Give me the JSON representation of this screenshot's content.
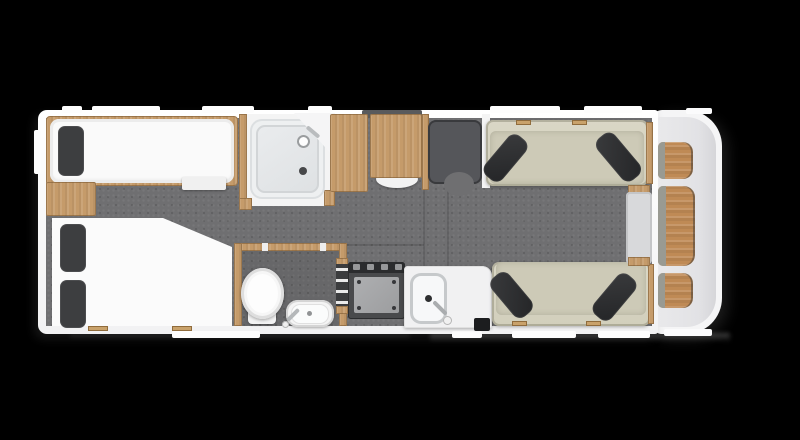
{
  "meta": {
    "type": "caravan-floor-plan",
    "orientation": "top-down"
  },
  "canvas": {
    "w": 800,
    "h": 440,
    "background": "#000000"
  },
  "palette": {
    "wall": "#f5f5f6",
    "floor": "#6f6f71",
    "wood": "#c59b6a",
    "front_wood": "#bf8a55",
    "mattress": "#fafafa",
    "pillow": "#3d3e40",
    "sofa": "#d6d3c1",
    "cushion": "#2e2f31",
    "fixture_white": "#f4f4f4",
    "hob_dark": "#494a4c",
    "vent": "#595a5c"
  },
  "items": [
    {
      "n": "ground-shadow-right",
      "x": 430,
      "y": 333,
      "w": 300,
      "h": 9,
      "f": "linear-gradient(180deg, rgba(150,150,150,0.45), rgba(0,0,0,0))",
      "flt": "blur(2px)"
    },
    {
      "n": "ground-shadow-left",
      "x": 70,
      "y": 333,
      "w": 340,
      "h": 7,
      "f": "linear-gradient(180deg, rgba(110,110,110,0.30), rgba(0,0,0,0))",
      "flt": "blur(2px)"
    },
    {
      "n": "front-body-outer",
      "x": 652,
      "y": 110,
      "w": 70,
      "h": 224,
      "f": "#f5f5f6",
      "r": "10px 36px 36px 10px",
      "s": "6px 5px 14px rgba(80,80,80,0.35)"
    },
    {
      "n": "main-body-wall",
      "x": 38,
      "y": 110,
      "w": 620,
      "h": 224,
      "f": "linear-gradient(180deg,#ffffff,#f2f2f3)",
      "r": "9px 3px 3px 9px",
      "s": "-4px 5px 10px rgba(70,70,70,0.30)"
    },
    {
      "n": "front-body-inner",
      "x": 658,
      "y": 117,
      "w": 58,
      "h": 210,
      "f": "linear-gradient(90deg,#e9e9eb,#e2e2e5 70%,#d6d6d9)",
      "r": "2px 30px 30px 2px"
    },
    {
      "n": "window-left-wall",
      "x": 34,
      "y": 130,
      "w": 7,
      "h": 44,
      "f": "#fdfdfd",
      "r": "2px"
    },
    {
      "n": "window-top-1",
      "x": 62,
      "y": 106,
      "w": 20,
      "h": 7,
      "f": "#fdfdfd",
      "r": "2px"
    },
    {
      "n": "window-top-2",
      "x": 92,
      "y": 106,
      "w": 68,
      "h": 7,
      "f": "#fdfdfd",
      "r": "2px"
    },
    {
      "n": "window-top-3",
      "x": 202,
      "y": 106,
      "w": 52,
      "h": 7,
      "f": "#fdfdfd",
      "r": "2px"
    },
    {
      "n": "window-top-4",
      "x": 308,
      "y": 106,
      "w": 24,
      "h": 7,
      "f": "#fdfdfd",
      "r": "2px"
    },
    {
      "n": "window-top-5",
      "x": 490,
      "y": 106,
      "w": 70,
      "h": 7,
      "f": "#fdfdfd",
      "r": "2px"
    },
    {
      "n": "window-top-6",
      "x": 584,
      "y": 106,
      "w": 58,
      "h": 7,
      "f": "#fdfdfd",
      "r": "2px"
    },
    {
      "n": "window-top-front",
      "x": 686,
      "y": 108,
      "w": 26,
      "h": 6,
      "f": "#fbfbfc",
      "r": "2px"
    },
    {
      "n": "window-bottom-1",
      "x": 172,
      "y": 331,
      "w": 88,
      "h": 7,
      "f": "#fdfdfd",
      "r": "2px"
    },
    {
      "n": "window-bottom-2",
      "x": 452,
      "y": 331,
      "w": 30,
      "h": 7,
      "f": "#fdfdfd",
      "r": "2px"
    },
    {
      "n": "window-bottom-3",
      "x": 512,
      "y": 331,
      "w": 64,
      "h": 7,
      "f": "#fdfdfd",
      "r": "2px"
    },
    {
      "n": "window-bottom-4",
      "x": 598,
      "y": 331,
      "w": 52,
      "h": 7,
      "f": "#fdfdfd",
      "r": "2px"
    },
    {
      "n": "window-bottom-front",
      "x": 664,
      "y": 329,
      "w": 48,
      "h": 7,
      "f": "#fbfbfc",
      "r": "2px"
    },
    {
      "n": "roof-vent",
      "x": 362,
      "y": 110,
      "w": 60,
      "h": 9,
      "f": "#595a5c",
      "r": "2px"
    },
    {
      "n": "interior-floor",
      "c": "floor",
      "x": 46,
      "y": 118,
      "w": 606,
      "h": 208
    },
    {
      "n": "floor-seam-1",
      "x": 423,
      "y": 186,
      "w": 2,
      "h": 80,
      "f": "rgba(0,0,0,0.13)"
    },
    {
      "n": "floor-seam-2",
      "x": 447,
      "y": 188,
      "w": 2,
      "h": 78,
      "f": "rgba(0,0,0,0.13)"
    },
    {
      "n": "floor-seam-3",
      "x": 346,
      "y": 244,
      "w": 78,
      "h": 2,
      "f": "rgba(0,0,0,0.13)"
    },
    {
      "n": "single-bed-frame",
      "c": "wood",
      "x": 46,
      "y": 116,
      "w": 192,
      "h": 70,
      "r": "4px"
    },
    {
      "n": "single-bed-mattress",
      "x": 50,
      "y": 119,
      "w": 184,
      "h": 64,
      "f": "#fafafa",
      "r": "9px",
      "s": "inset 0 0 0 3px #ececec, inset 0 -2px 4px rgba(0,0,0,0.12)"
    },
    {
      "n": "single-bed-pillow",
      "x": 58,
      "y": 126,
      "w": 26,
      "h": 50,
      "f": "#3d3e40",
      "r": "7px",
      "s": "inset 0 0 0 1px rgba(255,255,255,0.08)"
    },
    {
      "n": "bed-step",
      "x": 182,
      "y": 177,
      "w": 44,
      "h": 13,
      "f": "#f0f0f0",
      "r": "2px",
      "s": "0 1px 2px rgba(0,0,0,0.35)"
    },
    {
      "n": "left-cabinet",
      "c": "wood",
      "x": 46,
      "y": 182,
      "w": 50,
      "h": 34,
      "r": "2px"
    },
    {
      "n": "corner-bed",
      "x": 52,
      "y": 218,
      "w": 180,
      "h": 108,
      "f": "#fbfbfb",
      "p": "polygon(0 0, 111px 0, 180px 29px, 180px 108px, 0 108px)",
      "flt": "drop-shadow(0 0 2px rgba(0,0,0,0.35))"
    },
    {
      "n": "corner-bed-pillow-1",
      "x": 60,
      "y": 224,
      "w": 26,
      "h": 48,
      "f": "#3d3e40",
      "r": "7px",
      "s": "inset 0 0 0 1px rgba(255,255,255,0.08)"
    },
    {
      "n": "corner-bed-pillow-2",
      "x": 60,
      "y": 280,
      "w": 26,
      "h": 48,
      "f": "#3d3e40",
      "r": "7px",
      "s": "inset 0 0 0 1px rgba(255,255,255,0.08)"
    },
    {
      "n": "bed-hinge-1",
      "x": 88,
      "y": 326,
      "w": 20,
      "h": 5,
      "f": "#c9a26b",
      "s": "inset 0 0 0 1px rgba(120,85,40,0.7)"
    },
    {
      "n": "bed-hinge-2",
      "x": 172,
      "y": 326,
      "w": 20,
      "h": 5,
      "f": "#c9a26b",
      "s": "inset 0 0 0 1px rgba(120,85,40,0.7)"
    },
    {
      "n": "shower-room",
      "x": 244,
      "y": 114,
      "w": 88,
      "h": 92,
      "f": "#f4f4f4"
    },
    {
      "n": "shower-wall-left",
      "c": "wood",
      "x": 239,
      "y": 114,
      "w": 8,
      "h": 96
    },
    {
      "n": "shower-post-bottom-left",
      "c": "wood",
      "x": 239,
      "y": 198,
      "w": 13,
      "h": 12
    },
    {
      "n": "shower-post-bottom-right",
      "c": "wood",
      "x": 324,
      "y": 190,
      "w": 11,
      "h": 16
    },
    {
      "n": "shower-tray",
      "x": 250,
      "y": 119,
      "w": 75,
      "h": 80,
      "f": "#eef0f1",
      "r": "12px",
      "s": "inset 0 0 0 2px #dcdfe1"
    },
    {
      "n": "shower-tray-inner",
      "x": 256,
      "y": 125,
      "w": 63,
      "h": 68,
      "f": "linear-gradient(145deg,#eaecee,#dee1e3)",
      "r": "9px",
      "s": "inset 0 0 0 2px #d2d5d7"
    },
    {
      "n": "shower-corner-wall",
      "x": 294,
      "y": 113,
      "w": 41,
      "h": 45,
      "f": "#f5f5f6",
      "p": "polygon(0 0, 41px 0, 41px 45px)"
    },
    {
      "n": "shower-drain",
      "x": 299,
      "y": 167,
      "w": 8,
      "h": 8,
      "f": "#47484a",
      "r": "50%"
    },
    {
      "n": "shower-hose",
      "x": 305,
      "y": 130,
      "w": 16,
      "h": 4,
      "f": "#b9bcbe",
      "r": "2px",
      "o": 40
    },
    {
      "n": "shower-head-icon",
      "x": 297,
      "y": 135,
      "w": 13,
      "h": 13,
      "f": "#fdfdfd",
      "r": "50%",
      "s": "inset 0 0 0 2px #9a9d9f"
    },
    {
      "n": "wardrobe-left",
      "c": "wood",
      "x": 330,
      "y": 114,
      "w": 38,
      "h": 78,
      "r": "2px"
    },
    {
      "n": "stored-table",
      "x": 376,
      "y": 170,
      "w": 42,
      "h": 18,
      "f": "#f2f2f2",
      "r": "50%",
      "s": "0 1px 2px rgba(0,0,0,0.3)"
    },
    {
      "n": "wardrobe-right",
      "c": "wood",
      "x": 370,
      "y": 114,
      "w": 52,
      "h": 64,
      "r": "2px"
    },
    {
      "n": "door-post",
      "c": "wood",
      "x": 422,
      "y": 114,
      "w": 7,
      "h": 76
    },
    {
      "n": "entry-door-swing",
      "x": 428,
      "y": 120,
      "w": 54,
      "h": 64,
      "f": "#55565a",
      "r": "8px",
      "s": "inset 0 0 0 2px rgba(30,30,32,0.5)"
    },
    {
      "n": "entry-door-arc",
      "x": 444,
      "y": 172,
      "w": 30,
      "h": 24,
      "f": "#6f6f71",
      "r": "50%"
    },
    {
      "n": "door-wall-right",
      "x": 482,
      "y": 114,
      "w": 8,
      "h": 74,
      "f": "#f4f4f4"
    },
    {
      "n": "toilet-room-floor",
      "x": 241,
      "y": 250,
      "w": 100,
      "h": 76,
      "f": "rgba(0,0,0,0.07)"
    },
    {
      "n": "toilet-room-wall-top",
      "c": "wood",
      "x": 234,
      "y": 243,
      "w": 113,
      "h": 8
    },
    {
      "n": "toilet-room-wall-left",
      "c": "wood",
      "x": 234,
      "y": 243,
      "w": 8,
      "h": 83
    },
    {
      "n": "toilet-room-wall-right",
      "c": "wood",
      "x": 339,
      "y": 243,
      "w": 8,
      "h": 83
    },
    {
      "n": "toilet-door-cap-1",
      "x": 262,
      "y": 243,
      "w": 6,
      "h": 8,
      "f": "#eeeeee"
    },
    {
      "n": "toilet-door-cap-2",
      "x": 320,
      "y": 243,
      "w": 6,
      "h": 8,
      "f": "#eeeeee"
    },
    {
      "n": "toilet-base",
      "x": 248,
      "y": 308,
      "w": 28,
      "h": 16,
      "f": "#f3f3f3",
      "r": "4px",
      "s": "0 1px 2px rgba(0,0,0,0.3)"
    },
    {
      "n": "toilet-bowl",
      "x": 241,
      "y": 268,
      "w": 43,
      "h": 51,
      "f": "#f6f6f6",
      "r": "50%",
      "s": "inset 0 0 0 3px #dedede, 0 1px 3px rgba(0,0,0,0.35)"
    },
    {
      "n": "toilet-bowl-inner",
      "x": 247,
      "y": 274,
      "w": 31,
      "h": 39,
      "f": "#fdfdfd",
      "r": "50%"
    },
    {
      "n": "toilet-basin",
      "x": 286,
      "y": 300,
      "w": 48,
      "h": 27,
      "f": "#f4f4f4",
      "r": "12px",
      "s": "inset 0 0 0 2px #d5d5d5, 0 1px 2px rgba(0,0,0,0.3)"
    },
    {
      "n": "toilet-basin-inner",
      "x": 291,
      "y": 304,
      "w": 38,
      "h": 20,
      "f": "#fbfcfc",
      "r": "9px",
      "s": "inset 0 0 0 1px #e0e0e0"
    },
    {
      "n": "toilet-basin-drain",
      "x": 307,
      "y": 311,
      "w": 5,
      "h": 5,
      "f": "#919395",
      "r": "50%"
    },
    {
      "n": "toilet-basin-faucet",
      "x": 285,
      "y": 313,
      "w": 16,
      "h": 4,
      "f": "#b5b8ba",
      "r": "2px",
      "o": -45
    },
    {
      "n": "toilet-basin-knob",
      "x": 282,
      "y": 321,
      "w": 7,
      "h": 7,
      "f": "#f0f0f0",
      "r": "50%",
      "s": "inset 0 0 0 1px #b5b5b5"
    },
    {
      "n": "ladder-post-top",
      "c": "wood",
      "x": 336,
      "y": 258,
      "w": 12,
      "h": 8
    },
    {
      "n": "bunk-ladder",
      "c": "ladder",
      "x": 336,
      "y": 264,
      "w": 12,
      "h": 44
    },
    {
      "n": "ladder-post-bottom",
      "c": "wood",
      "x": 336,
      "y": 306,
      "w": 12,
      "h": 8
    },
    {
      "n": "hob-unit",
      "x": 348,
      "y": 262,
      "w": 57,
      "h": 57,
      "f": "#494a4c",
      "r": "3px",
      "s": "inset 0 0 0 1px #2c2d2f"
    },
    {
      "n": "hob-control-strip",
      "x": 348,
      "y": 262,
      "w": 57,
      "h": 11,
      "f": "#2b2c2e",
      "r": "3px 3px 0 0"
    },
    {
      "n": "hob-knob-1",
      "x": 353,
      "y": 264,
      "w": 7,
      "h": 6,
      "f": "#97989a",
      "r": "1px"
    },
    {
      "n": "hob-knob-2",
      "x": 367,
      "y": 264,
      "w": 7,
      "h": 6,
      "f": "#97989a",
      "r": "1px"
    },
    {
      "n": "hob-knob-3",
      "x": 381,
      "y": 264,
      "w": 7,
      "h": 6,
      "f": "#97989a",
      "r": "1px"
    },
    {
      "n": "hob-knob-4",
      "x": 395,
      "y": 264,
      "w": 7,
      "h": 6,
      "f": "#97989a",
      "r": "1px"
    },
    {
      "n": "hob-panel",
      "x": 354,
      "y": 277,
      "w": 45,
      "h": 36,
      "f": "linear-gradient(135deg,#aeafb1,#9c9d9f)",
      "r": "2px"
    },
    {
      "n": "hob-screw-1",
      "x": 357,
      "y": 280,
      "w": 4,
      "h": 4,
      "f": "#36373a",
      "r": "50%"
    },
    {
      "n": "hob-screw-2",
      "x": 392,
      "y": 280,
      "w": 4,
      "h": 4,
      "f": "#36373a",
      "r": "50%"
    },
    {
      "n": "hob-screw-3",
      "x": 357,
      "y": 306,
      "w": 4,
      "h": 4,
      "f": "#36373a",
      "r": "50%"
    },
    {
      "n": "hob-screw-4",
      "x": 392,
      "y": 306,
      "w": 4,
      "h": 4,
      "f": "#36373a",
      "r": "50%"
    },
    {
      "n": "kitchen-counter",
      "x": 404,
      "y": 266,
      "w": 88,
      "h": 62,
      "f": "#f1f1f2",
      "r": "4px 10px 2px 2px",
      "s": "inset 0 0 0 1px #e0e0e0, 0 1px 3px rgba(0,0,0,0.3)"
    },
    {
      "n": "kitchen-sink",
      "x": 410,
      "y": 273,
      "w": 37,
      "h": 51,
      "f": "#f7f8f9",
      "r": "11px",
      "s": "inset 0 0 0 3px #c6c9cb"
    },
    {
      "n": "kitchen-sink-drain",
      "x": 425,
      "y": 295,
      "w": 7,
      "h": 7,
      "f": "#2e2f31",
      "r": "50%"
    },
    {
      "n": "kitchen-faucet",
      "x": 431,
      "y": 306,
      "w": 18,
      "h": 4,
      "f": "#aaadaf",
      "r": "2px",
      "o": 45
    },
    {
      "n": "kitchen-faucet-knob",
      "x": 443,
      "y": 316,
      "w": 9,
      "h": 9,
      "f": "#f1f1f1",
      "r": "50%",
      "s": "inset 0 0 0 1px #b5b5b5"
    },
    {
      "n": "waste-bin",
      "x": 474,
      "y": 318,
      "w": 16,
      "h": 13,
      "f": "#1c1d1f",
      "r": "2px"
    },
    {
      "n": "sofa-top",
      "c": "sofa",
      "x": 486,
      "y": 120,
      "w": 162,
      "h": 66,
      "r": "7px"
    },
    {
      "n": "sofa-top-seat",
      "c": "sofa-seat",
      "x": 490,
      "y": 131,
      "w": 154,
      "h": 53,
      "r": "6px"
    },
    {
      "n": "sofa-top-cushion-left",
      "c": "dark-cushion",
      "x": 494,
      "y": 132,
      "w": 23,
      "h": 52,
      "r": "9px",
      "o": 40
    },
    {
      "n": "sofa-top-cushion-right",
      "c": "dark-cushion",
      "x": 607,
      "y": 130,
      "w": 23,
      "h": 54,
      "r": "9px",
      "o": -40
    },
    {
      "n": "sofa-top-hinge-1",
      "x": 516,
      "y": 120,
      "w": 15,
      "h": 5,
      "f": "#c9a26b",
      "s": "inset 0 0 0 1px rgba(120,85,40,0.7)"
    },
    {
      "n": "sofa-top-hinge-2",
      "x": 572,
      "y": 120,
      "w": 15,
      "h": 5,
      "f": "#c9a26b",
      "s": "inset 0 0 0 1px rgba(120,85,40,0.7)"
    },
    {
      "n": "sofa-top-wood-end",
      "c": "wood",
      "x": 646,
      "y": 122,
      "w": 7,
      "h": 62
    },
    {
      "n": "sofa-bottom",
      "c": "sofa",
      "x": 492,
      "y": 262,
      "w": 158,
      "h": 64,
      "r": "7px"
    },
    {
      "n": "sofa-bottom-seat",
      "c": "sofa-seat",
      "x": 496,
      "y": 262,
      "w": 150,
      "h": 53,
      "r": "6px"
    },
    {
      "n": "sofa-bottom-cushion-left",
      "c": "dark-cushion",
      "x": 500,
      "y": 270,
      "w": 23,
      "h": 50,
      "r": "9px",
      "o": -40
    },
    {
      "n": "sofa-bottom-cushion-right",
      "c": "dark-cushion",
      "x": 603,
      "y": 271,
      "w": 23,
      "h": 52,
      "r": "9px",
      "o": 40
    },
    {
      "n": "sofa-bottom-hinge-1",
      "x": 512,
      "y": 321,
      "w": 15,
      "h": 5,
      "f": "#c9a26b",
      "s": "inset 0 0 0 1px rgba(120,85,40,0.7)"
    },
    {
      "n": "sofa-bottom-hinge-2",
      "x": 586,
      "y": 321,
      "w": 15,
      "h": 5,
      "f": "#c9a26b",
      "s": "inset 0 0 0 1px rgba(120,85,40,0.7)"
    },
    {
      "n": "sofa-bottom-wood-end",
      "c": "wood",
      "x": 648,
      "y": 264,
      "w": 6,
      "h": 60
    },
    {
      "n": "lounge-table-cap-top",
      "c": "wood",
      "x": 628,
      "y": 185,
      "w": 22,
      "h": 9
    },
    {
      "n": "lounge-table-top",
      "x": 626,
      "y": 192,
      "w": 26,
      "h": 72,
      "f": "#d8d9db",
      "r": "4px",
      "s": "inset 0 0 0 2px #c4c5c7"
    },
    {
      "n": "lounge-table-cap-bottom",
      "c": "wood",
      "x": 628,
      "y": 257,
      "w": 22,
      "h": 9
    },
    {
      "n": "front-seat-top",
      "c": "front-wood",
      "x": 658,
      "y": 142,
      "w": 35,
      "h": 37,
      "r": "5px 10px 10px 5px"
    },
    {
      "n": "front-seat-top-armrest",
      "x": 658,
      "y": 142,
      "w": 7,
      "h": 37,
      "f": "#999a92",
      "r": "5px 0 0 5px"
    },
    {
      "n": "front-sideboard",
      "c": "front-wood",
      "x": 658,
      "y": 186,
      "w": 37,
      "h": 80,
      "r": "5px 11px 11px 5px"
    },
    {
      "n": "front-sideboard-trim",
      "x": 658,
      "y": 186,
      "w": 8,
      "h": 80,
      "f": "#999a92",
      "r": "5px 0 0 5px"
    },
    {
      "n": "front-seat-bottom",
      "c": "front-wood",
      "x": 658,
      "y": 273,
      "w": 35,
      "h": 35,
      "r": "5px 10px 10px 5px"
    },
    {
      "n": "front-seat-bottom-armrest",
      "x": 658,
      "y": 273,
      "w": 7,
      "h": 35,
      "f": "#999a92",
      "r": "5px 0 0 5px"
    }
  ]
}
